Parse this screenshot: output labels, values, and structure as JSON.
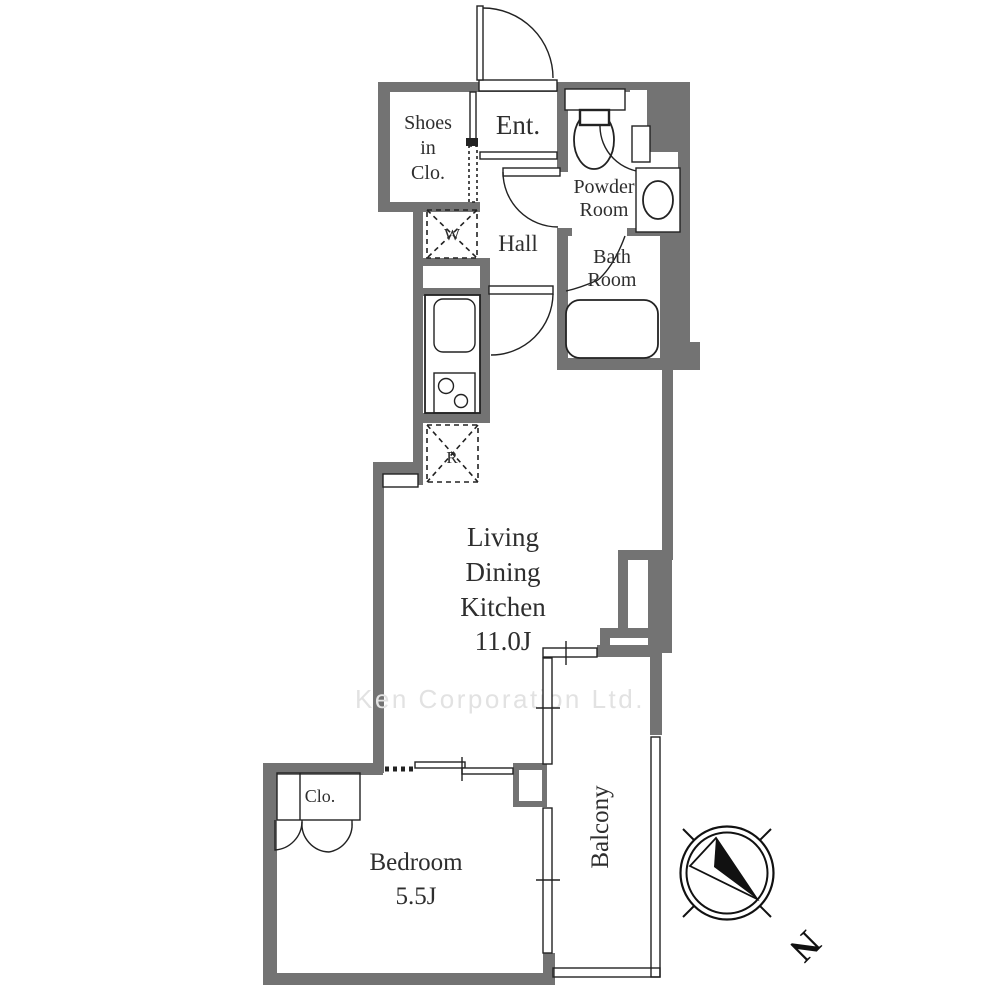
{
  "floor_plan": {
    "watermark": "Ken Corporation Ltd.",
    "compass": {
      "north_label": "N"
    },
    "rooms": {
      "shoes_closet": {
        "line1": "Shoes",
        "line2": "in",
        "line3": "Clo."
      },
      "entrance": {
        "label": "Ent."
      },
      "powder_room": {
        "line1": "Powder",
        "line2": "Room"
      },
      "hall": {
        "label": "Hall"
      },
      "bath_room": {
        "line1": "Bath",
        "line2": "Room"
      },
      "washing_machine": {
        "label": "W"
      },
      "refrigerator": {
        "label": "R"
      },
      "living_dining_kitchen": {
        "line1": "Living",
        "line2": "Dining",
        "line3": "Kitchen",
        "size": "11.0J"
      },
      "closet": {
        "label": "Clo."
      },
      "bedroom": {
        "label": "Bedroom",
        "size": "5.5J"
      },
      "balcony": {
        "label": "Balcony"
      }
    },
    "colors": {
      "wall": "#737373",
      "line": "#222222",
      "text": "#2e2e2e",
      "watermark": "#e2e2e2",
      "background": "#ffffff"
    }
  }
}
